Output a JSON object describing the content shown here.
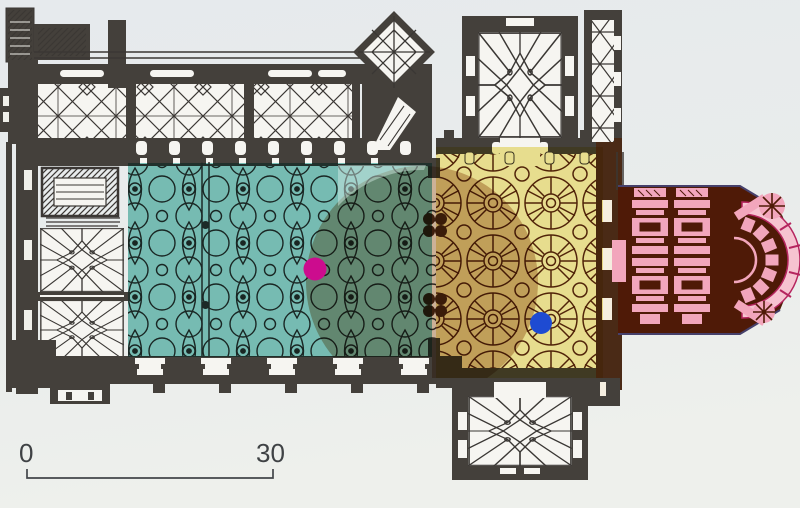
{
  "figure": {
    "kind": "scanned floor plan of a Gothic church with colored analysis overlays",
    "scale_bar": {
      "start_label": "0",
      "end_label": "30"
    },
    "paper_color": "#e9eceb",
    "ink_color": "#3d3936",
    "overlays": {
      "nave_zone": {
        "label": "teal nave zone",
        "color": "#54b2ab",
        "opacity": 0.78
      },
      "pale_corner": {
        "label": "pale corner highlight",
        "color": "#d9efe9",
        "opacity": 0.45
      },
      "choir_zone": {
        "label": "yellow choir zone",
        "color": "#ece07c",
        "opacity": 0.8
      },
      "circle_zone": {
        "label": "tan circle zone",
        "color": "#c49c7c",
        "opacity": 0.72,
        "cx": 422,
        "cy": 282,
        "r": 116
      }
    },
    "apse": {
      "poche_color": "#4f1a07",
      "detail_color": "#f2a6bc",
      "outer_ring_color": "#f6c3d0",
      "ring_stroke": "#b5255e",
      "edge_line_color": "#46406b"
    },
    "markers": {
      "magenta": {
        "color": "#cc0c8e",
        "cx": 315,
        "cy": 269,
        "r": 11.5
      },
      "blue": {
        "color": "#1e4bd2",
        "cx": 541,
        "cy": 323,
        "r": 11
      }
    }
  }
}
